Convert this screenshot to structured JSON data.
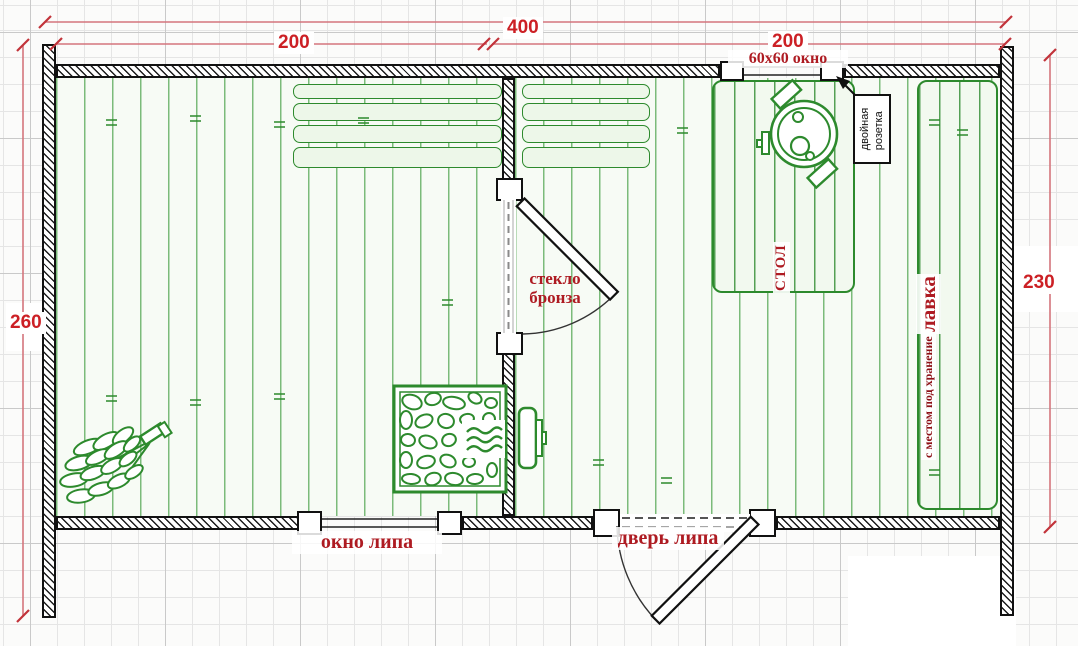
{
  "plan": {
    "dimensions": {
      "overall_width": "400",
      "left_section_width": "200",
      "right_section_width": "200",
      "left_height": "260",
      "right_height": "230"
    },
    "openings": {
      "top_window": "60x60 окно",
      "bottom_window": "окно липа",
      "entrance_door": "дверь липа",
      "inner_door_line1": "стекло",
      "inner_door_line2": "бронза"
    },
    "fixtures": {
      "outlet_line1": "двойная",
      "outlet_line2": "розетка",
      "table": "СТОЛ",
      "bench": "лавка",
      "bench_note": "с местом под хранение"
    },
    "colors": {
      "dimension_red": "#cc2025",
      "label_dark_red": "#ae1b22",
      "furniture_green": "#2d8a2d",
      "wall_black": "#111111"
    }
  }
}
